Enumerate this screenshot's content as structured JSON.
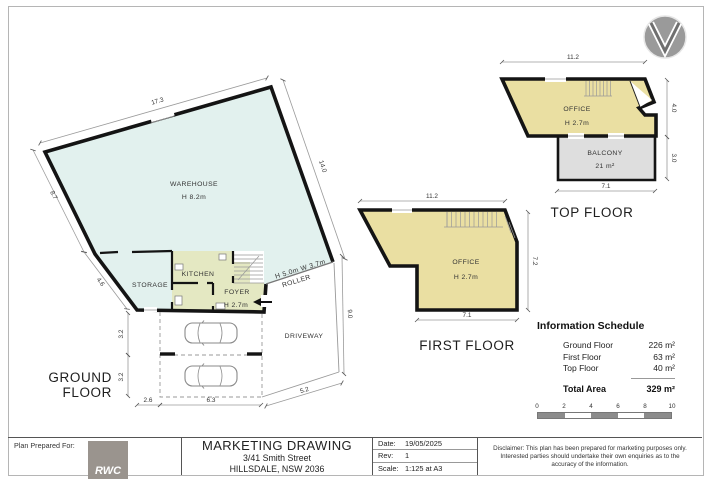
{
  "compass": {
    "icon": "north-arrow"
  },
  "colors": {
    "warehouse_fill": "#e2f1ee",
    "office_fill": "#eadfa2",
    "foyer_fill": "#e4e8c2",
    "balcony_fill": "#dedede",
    "wall": "#141414",
    "logo_grey": "#9a948e"
  },
  "ground_floor": {
    "title_line1": "GROUND",
    "title_line2": "FLOOR",
    "labels": {
      "warehouse": "WAREHOUSE",
      "warehouse_height": "H 8.2m",
      "storage": "STORAGE",
      "kitchen": "KITCHEN",
      "foyer": "FOYER",
      "foyer_height": "H 2.7m",
      "driveway": "DRIVEWAY",
      "roller_size": "H 5.0m W 3.7m",
      "roller": "ROLLER"
    },
    "dims": {
      "top": "17.3",
      "right": "14.0",
      "left_upper": "8.7",
      "left_lower": "4.6",
      "parking_upper": "3.2",
      "parking_lower": "3.2",
      "bottom_left": "2.6",
      "bottom_right": "6.3",
      "driveway_right": "9.0",
      "driveway_bottom": "5.2"
    }
  },
  "first_floor": {
    "title": "FIRST FLOOR",
    "labels": {
      "office": "OFFICE",
      "office_height": "H 2.7m"
    },
    "dims": {
      "top": "11.2",
      "right": "7.2",
      "bottom": "7.1"
    }
  },
  "top_floor": {
    "title": "TOP FLOOR",
    "labels": {
      "office": "OFFICE",
      "office_height": "H 2.7m",
      "balcony": "BALCONY",
      "balcony_area": "21 m²"
    },
    "dims": {
      "top": "11.2",
      "right_upper": "4.0",
      "right_lower": "3.0",
      "bottom": "7.1"
    }
  },
  "information_schedule": {
    "title": "Information Schedule",
    "rows": [
      {
        "label": "Ground Floor",
        "value": "226 m²"
      },
      {
        "label": "First Floor",
        "value": "63 m²"
      },
      {
        "label": "Top Floor",
        "value": "40 m²"
      }
    ],
    "total_label": "Total Area",
    "total_value": "329 m²",
    "scale_ticks": [
      "0",
      "2",
      "4",
      "6",
      "8",
      "10"
    ]
  },
  "title_block": {
    "prepared_for": "Plan Prepared For:",
    "logo": "RWC",
    "heading": "MARKETING DRAWING",
    "address_line1": "3/41 Smith Street",
    "address_line2": "HILLSDALE, NSW 2036",
    "date_label": "Date:",
    "date_value": "19/05/2025",
    "rev_label": "Rev:",
    "rev_value": "1",
    "scale_label": "Scale:",
    "scale_value": "1:125 at A3",
    "disclaimer": "Disclaimer: This plan has been prepared for marketing purposes only. Interested parties should undertake their own enquiries as to the accuracy of the information."
  }
}
